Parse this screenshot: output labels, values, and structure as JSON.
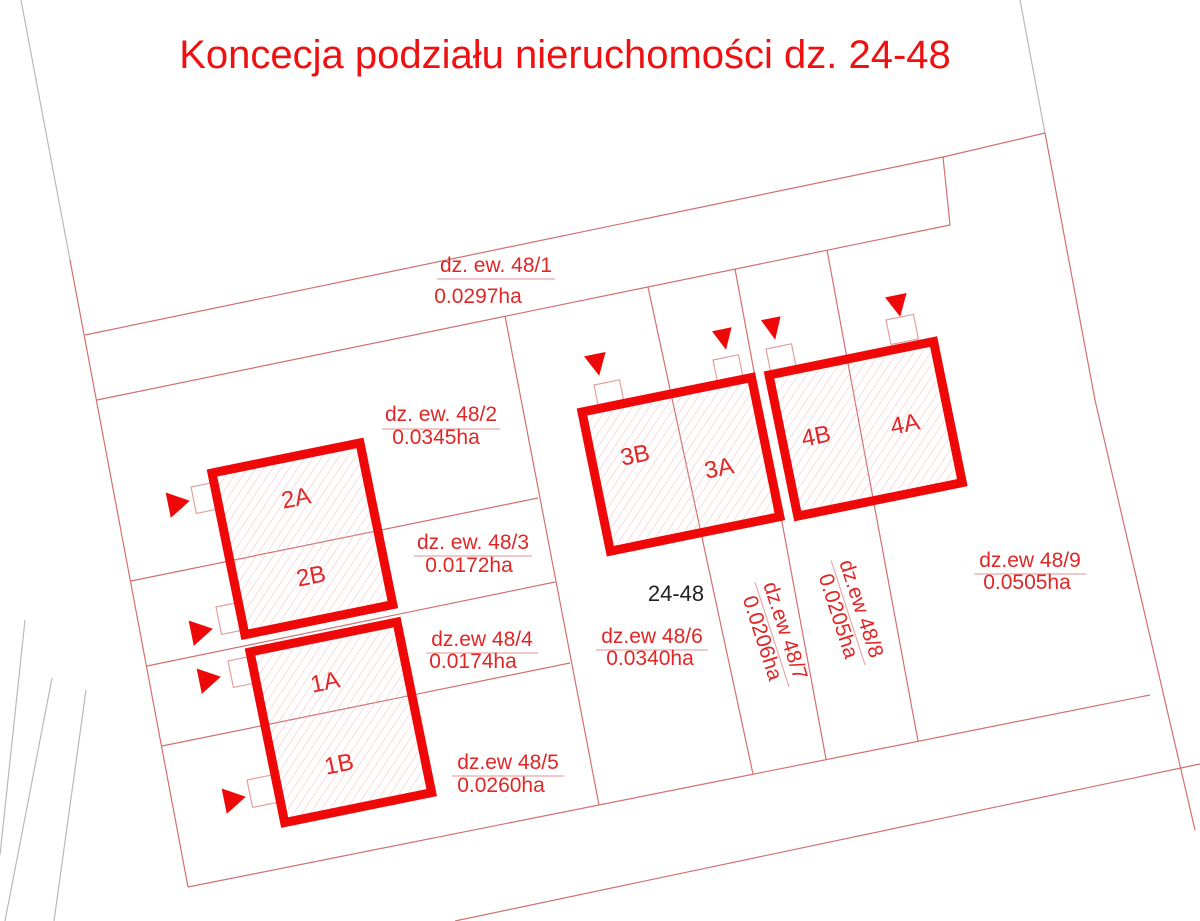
{
  "title": "Koncecja podziału nieruchomości dz. 24-48",
  "original_plot": "24-48",
  "parcels": [
    {
      "label": "dz. ew. 48/1",
      "area": "0.0297ha"
    },
    {
      "label": "dz. ew. 48/2",
      "area": "0.0345ha"
    },
    {
      "label": "dz. ew. 48/3",
      "area": "0.0172ha"
    },
    {
      "label": "dz.ew 48/4",
      "area": "0.0174ha"
    },
    {
      "label": "dz.ew 48/5",
      "area": "0.0260ha"
    },
    {
      "label": "dz.ew 48/6",
      "area": "0.0340ha"
    },
    {
      "label": "dz.ew 48/7",
      "area": "0.0206ha"
    },
    {
      "label": "dz.ew 48/8",
      "area": "0.0205ha"
    },
    {
      "label": "dz.ew 48/9",
      "area": "0.0505ha"
    }
  ],
  "units": {
    "2A": "2A",
    "2B": "2B",
    "1A": "1A",
    "1B": "1B",
    "3B": "3B",
    "3A": "3A",
    "4B": "4B",
    "4A": "4A"
  },
  "colors": {
    "building_red": "#ee0808",
    "parcel_line_red": "#d1716f",
    "text_red": "#e12626",
    "neighbor_gray": "#b9b9b9",
    "black": "#222222"
  }
}
